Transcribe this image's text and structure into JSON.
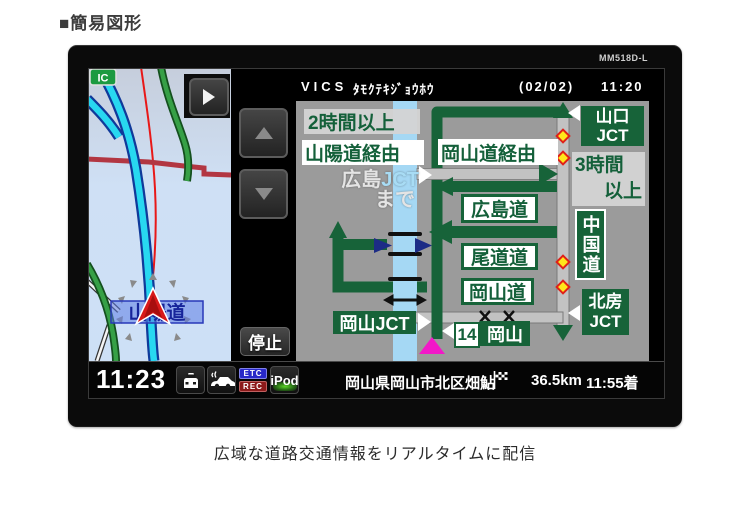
{
  "page": {
    "title": "■簡易図形",
    "caption": "広域な道路交通情報をリアルタイムに配信"
  },
  "device": {
    "model": "MM518D-L"
  },
  "header": {
    "system": "VICS",
    "info": "ﾀﾓｸﾃｷｼﾞｮｳﾎｳ",
    "page": "(02/02)",
    "time": "11:20"
  },
  "map": {
    "ic_badge": "IC",
    "road_label": "山陽道"
  },
  "side_controls": {
    "stop": "停止"
  },
  "diagram": {
    "duration_left": "2時間以上",
    "via_left": "山陽道経由",
    "dest_name": "広島",
    "dest_jct": "JCT",
    "dest_suffix": "まで",
    "via_right": "岡山道経由",
    "road_hiroshima": "広島道",
    "road_onomichi": "尾道道",
    "road_okayama": "岡山道",
    "jct_yamaguchi_1": "山口",
    "jct_yamaguchi_2": "JCT",
    "duration_right_1": "3時間",
    "duration_right_2": "以上",
    "road_chugoku": "中国道",
    "jct_hokubo_1": "北房",
    "jct_hokubo_2": "JCT",
    "jct_okayama": "岡山JCT",
    "exit_number": "14",
    "exit_name": "岡山"
  },
  "status": {
    "clock": "11:23",
    "etc": "ETC",
    "rec": "REC",
    "ipod": "iPod",
    "location": "岡山県岡山市北区畑鮎",
    "distance": "36.5km",
    "arrival": "11:55着"
  },
  "colors": {
    "route_green": "#176339",
    "band_blue": "#a5d8f4",
    "panel_gray": "#9b9b9b",
    "caution_yellow": "#ffe61a",
    "position_magenta": "#f218c8"
  }
}
